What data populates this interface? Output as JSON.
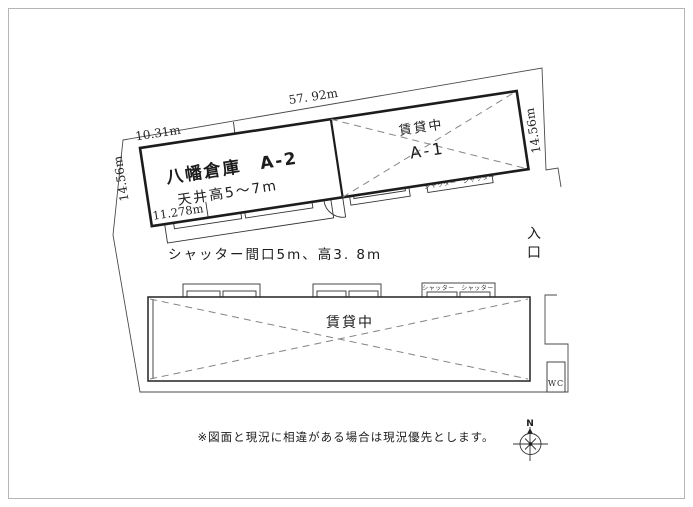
{
  "colors": {
    "ink": "#1c1c1c",
    "boundary_line": "#4a4a4a",
    "dashed_line": "#848484",
    "border_frame": "#b5b5b5",
    "background": "#ffffff"
  },
  "upper_building": {
    "title": "八幡倉庫　A-2",
    "ceiling": "天井高5～7m",
    "a1_status": "賃貸中",
    "a1_label": "A-1",
    "shutters": "シャッター　シャッター",
    "dim_top_total": "57. 92m",
    "dim_top_partial": "10.31m",
    "dim_left": "14.56m",
    "dim_right": "14.56m",
    "dim_bottom_partial": "11.278m"
  },
  "notes": {
    "shutter_spec": "シャッター間口5m、高3. 8m",
    "disclaimer": "※図面と現況に相違がある場合は現況優先とします。"
  },
  "lower_building": {
    "status": "賃貸中",
    "shutters": "シャッター　シャッター",
    "wc": "WC"
  },
  "site": {
    "entrance_char1": "入",
    "entrance_char2": "口",
    "compass_north": "N"
  }
}
